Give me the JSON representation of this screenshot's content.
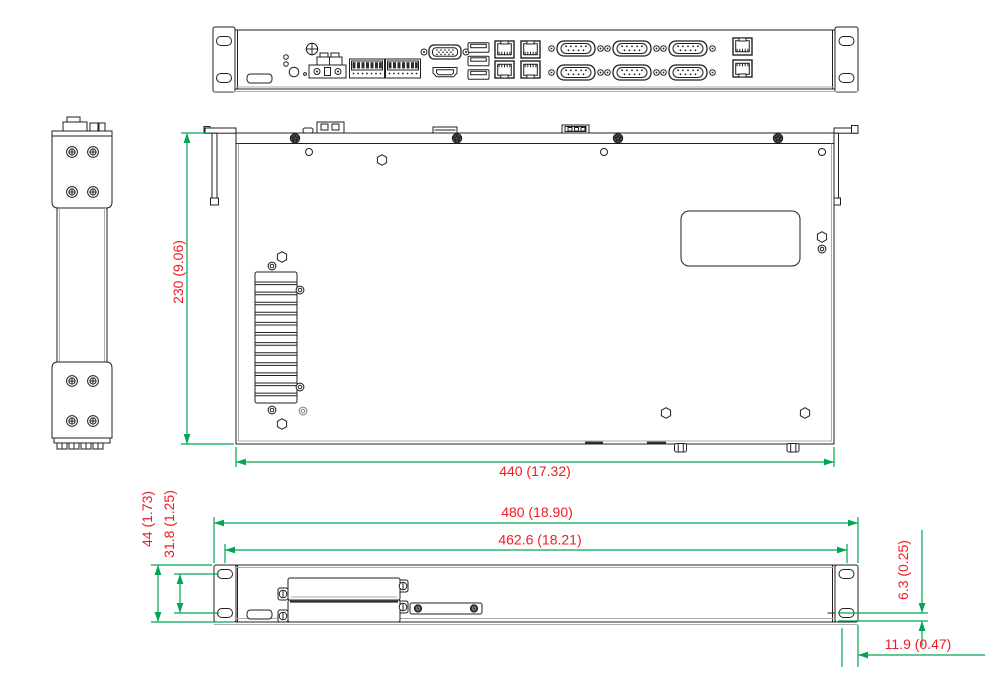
{
  "drawing": {
    "type": "mechanical-dimension-drawing",
    "views": [
      "front-panel",
      "side",
      "top",
      "bottom-front"
    ],
    "colors": {
      "dimension_line": "#00a651",
      "dimension_text": "#ed1c24",
      "drawing_line": "#231f20",
      "background": "#ffffff"
    },
    "dimensions": {
      "depth": "230 (9.06)",
      "body_width": "440 (17.32)",
      "overall_width": "480 (18.90)",
      "opening_width": "462.6 (18.21)",
      "height": "44 (1.73)",
      "hole_spacing": "31.8 (1.25)",
      "bottom_gap": "6.3 (0.25)",
      "side_gap": "11.9 (0.47)"
    }
  }
}
